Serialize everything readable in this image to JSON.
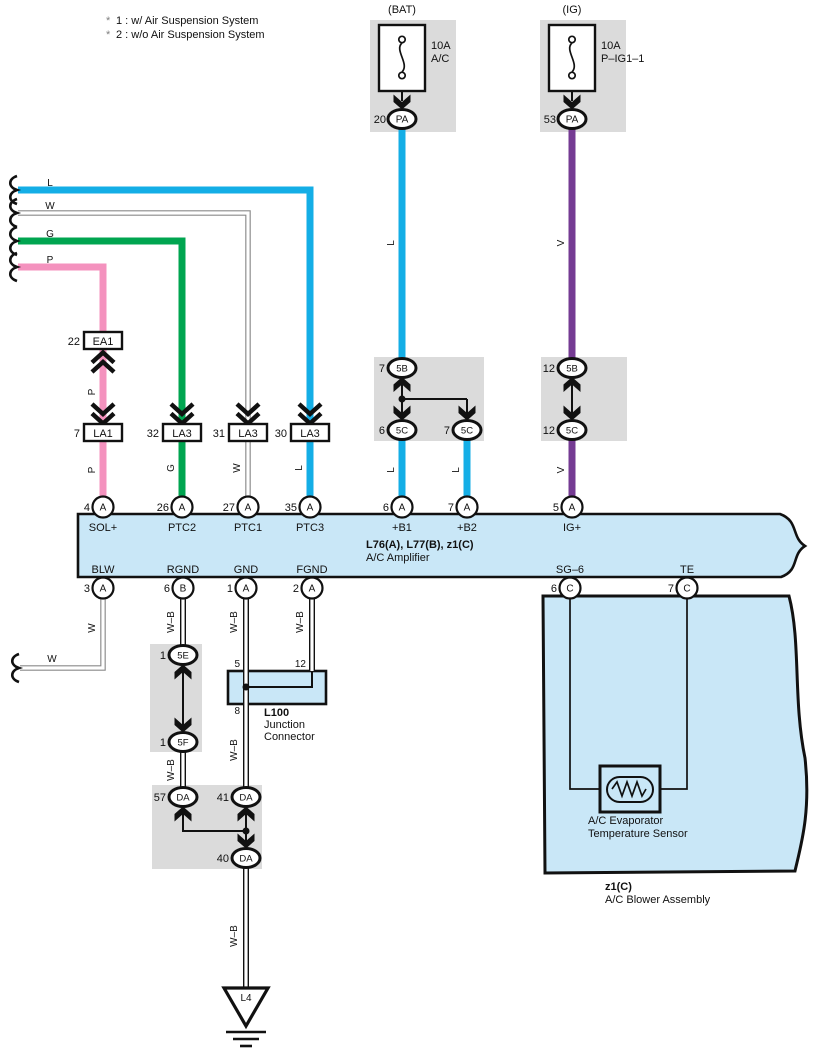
{
  "legend": {
    "items": [
      {
        "star": "*",
        "text": "1 : w/ Air Suspension System"
      },
      {
        "star": "*",
        "text": "2 : w/o Air Suspension System"
      }
    ]
  },
  "fuses": {
    "bat": {
      "source": "(BAT)",
      "rating": "10A",
      "circuit": "A/C",
      "pin": "20",
      "terminal": "PA"
    },
    "ig": {
      "source": "(IG)",
      "rating": "10A",
      "circuit": "P–IG1–1",
      "pin": "53",
      "terminal": "PA"
    }
  },
  "entry_wires": {
    "l": "L",
    "w": "W",
    "g": "G",
    "p": "P"
  },
  "connectors": {
    "ea1": {
      "pin": "22",
      "label": "EA1"
    },
    "la1": {
      "pin": "7",
      "label": "LA1"
    },
    "la3_g": {
      "pin": "32",
      "label": "LA3"
    },
    "la3_w": {
      "pin": "31",
      "label": "LA3"
    },
    "la3_l": {
      "pin": "30",
      "label": "LA3"
    }
  },
  "junctions": {
    "bat": {
      "top_pin": "7",
      "top": "5B",
      "left_pin": "6",
      "left": "5C",
      "right_pin": "7",
      "right": "5C"
    },
    "ig": {
      "top_pin": "12",
      "top": "5B",
      "bottom_pin": "12",
      "bottom": "5C"
    },
    "ef": {
      "top_pin": "1",
      "top": "5E",
      "bottom_pin": "1",
      "bottom": "5F"
    },
    "da": {
      "left_pin": "57",
      "left": "DA",
      "mid_pin": "41",
      "mid": "DA",
      "bottom_pin": "40",
      "bottom": "DA"
    }
  },
  "wire_labels": {
    "bat_down": "L",
    "ig_down": "V",
    "p_mid": "P",
    "p_low": "P",
    "g_low": "G",
    "w_low": "W",
    "l_low": "L",
    "b1": "L",
    "b2": "L",
    "igplus": "V",
    "blw_v": "W",
    "blw_h": "W",
    "rgnd_up": "W–B",
    "gnd_up": "W–B",
    "fgnd_up": "W–B",
    "rgnd_low": "W–B",
    "gnd_low": "W–B",
    "gnd_tail": "W–B"
  },
  "amplifier": {
    "title": "L76(A), L77(B), z1(C)",
    "subtitle": "A/C Amplifier",
    "top_pins": [
      {
        "num": "4",
        "conn": "A",
        "label": "SOL+"
      },
      {
        "num": "26",
        "conn": "A",
        "label": "PTC2"
      },
      {
        "num": "27",
        "conn": "A",
        "label": "PTC1"
      },
      {
        "num": "35",
        "conn": "A",
        "label": "PTC3"
      },
      {
        "num": "6",
        "conn": "A",
        "label": "+B1"
      },
      {
        "num": "7",
        "conn": "A",
        "label": "+B2"
      },
      {
        "num": "5",
        "conn": "A",
        "label": "IG+"
      }
    ],
    "bottom_pins": [
      {
        "num": "3",
        "conn": "A",
        "label": "BLW"
      },
      {
        "num": "6",
        "conn": "B",
        "label": "RGND"
      },
      {
        "num": "1",
        "conn": "A",
        "label": "GND"
      },
      {
        "num": "2",
        "conn": "A",
        "label": "FGND"
      },
      {
        "num": "6",
        "conn": "C",
        "label": "SG–6"
      },
      {
        "num": "7",
        "conn": "C",
        "label": "TE"
      }
    ]
  },
  "l100": {
    "name": "L100",
    "desc1": "Junction",
    "desc2": "Connector",
    "pin_top": "5",
    "pin_branch": "12",
    "pin_bottom": "8"
  },
  "ground": {
    "label": "L4"
  },
  "blower": {
    "code": "z1(C)",
    "name": "A/C Blower Assembly",
    "sensor": {
      "line1": "A/C Evaporator",
      "line2": "Temperature Sensor"
    }
  },
  "colors": {
    "blue": "#14AEE6",
    "green": "#00A550",
    "pink": "#F492BE",
    "purple": "#753B93",
    "panel": "#C9E7F7",
    "box_gray": "#DBDBDB"
  }
}
